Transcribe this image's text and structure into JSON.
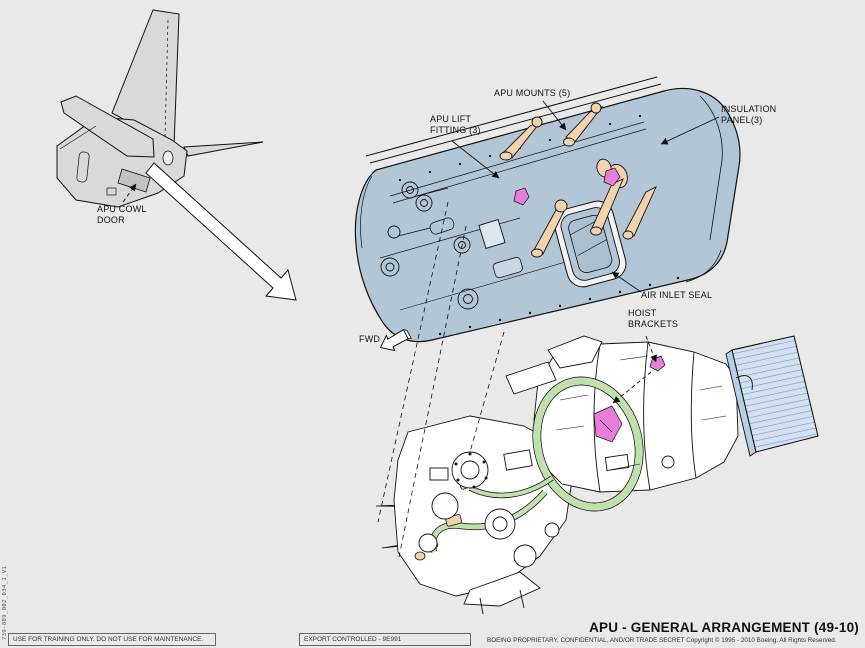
{
  "title": "APU - GENERAL ARRANGEMENT (49-10)",
  "doc_number": "739-889_002_034_1_V1",
  "callouts": {
    "apu_cowl_door": "APU COWL DOOR",
    "apu_mounts": "APU MOUNTS (5)",
    "apu_lift_fitting": "APU LIFT FITTING (3)",
    "insulation_panel": "INSULATION PANEL(3)",
    "air_inlet_seal": "AIR INLET SEAL",
    "hoist_brackets": "HOIST BRACKETS",
    "fwd": "FWD"
  },
  "footer": {
    "training_notice": "USE FOR TRAINING ONLY. DO NOT USE FOR MAINTENANCE.",
    "export_notice": "EXPORT CONTROLLED - 9E991",
    "proprietary_notice": "BOEING PROPRIETARY, CONFIDENTIAL, AND/OR TRADE SECRET   Copyright © 1995 - 2010  Boeing. All Rights Reserved."
  },
  "colors": {
    "background": "#e9e9e9",
    "door_fill": "#b2c6d5",
    "mount_fill": "#f3d3ad",
    "highlight_magenta": "#e57fd9",
    "harness_green": "#bfe2ad",
    "cooler_blue": "#d3e1f2",
    "airframe_gray": "#d9d9d9"
  }
}
